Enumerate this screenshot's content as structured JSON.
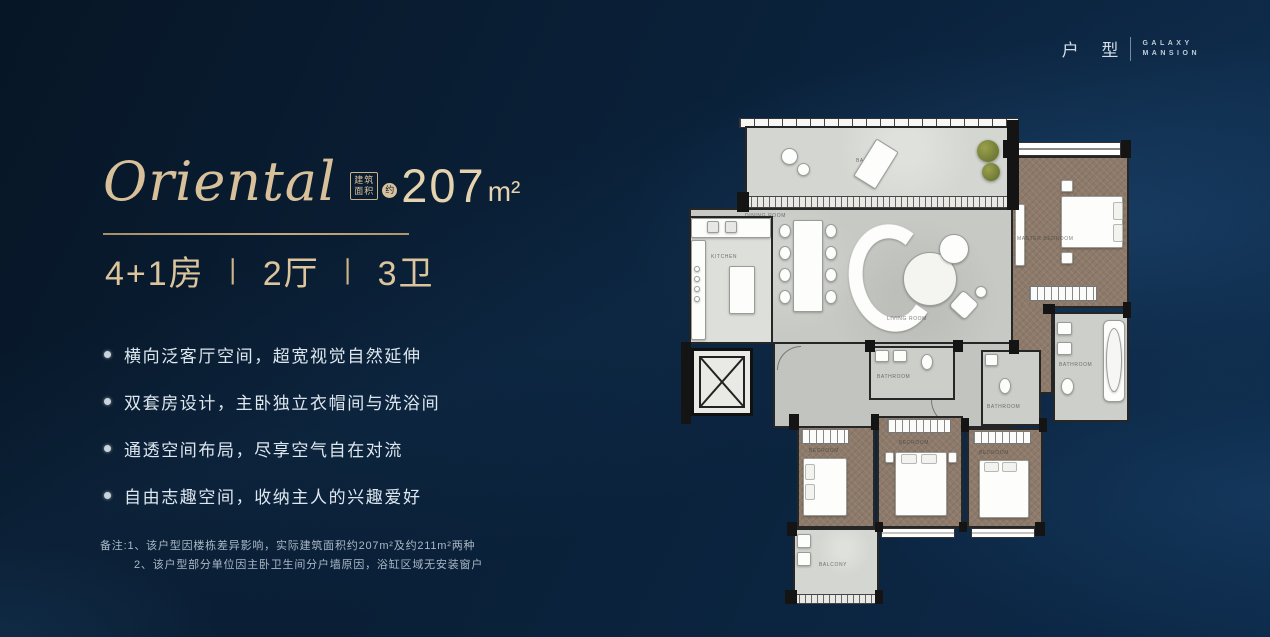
{
  "brand": {
    "cn": "户 型",
    "en1": "GALAXY",
    "en2": "MANSION"
  },
  "header": {
    "title": "Oriental",
    "badge_top": "建筑",
    "badge_bottom": "面积",
    "badge_circle": "约",
    "area": "207",
    "unit": "m²"
  },
  "config": {
    "beds": "4+1房",
    "sep": "丨",
    "halls": "2厅",
    "baths": "3卫"
  },
  "features": [
    "横向泛客厅空间，超宽视觉自然延伸",
    "双套房设计，主卧独立衣帽间与洗浴间",
    "通透空间布局，尽享空气自在对流",
    "自由志趣空间，收纳主人的兴趣爱好"
  ],
  "notes": {
    "prefix": "备注:",
    "line1": "1、该户型因楼栋差异影响，实际建筑面积约207m²及约211m²两种",
    "line2": "2、该户型部分单位因主卧卫生间分户墙原因，浴缸区域无安装窗户"
  },
  "floorplan": {
    "labels": {
      "balcony": "BALCONY",
      "dining": "DINING ROOM",
      "living": "LIVING ROOM",
      "kitchen": "KITCHEN",
      "master": "MASTER BEDROOM",
      "bath": "BATHROOM",
      "bedroom": "BEDROOM"
    }
  },
  "colors": {
    "background": "#081a30",
    "accent_gold": "#d8c09a",
    "text_light": "#dde7ef",
    "wood_floor": "#8d7a6a",
    "stone_floor": "#c7c9c4"
  }
}
